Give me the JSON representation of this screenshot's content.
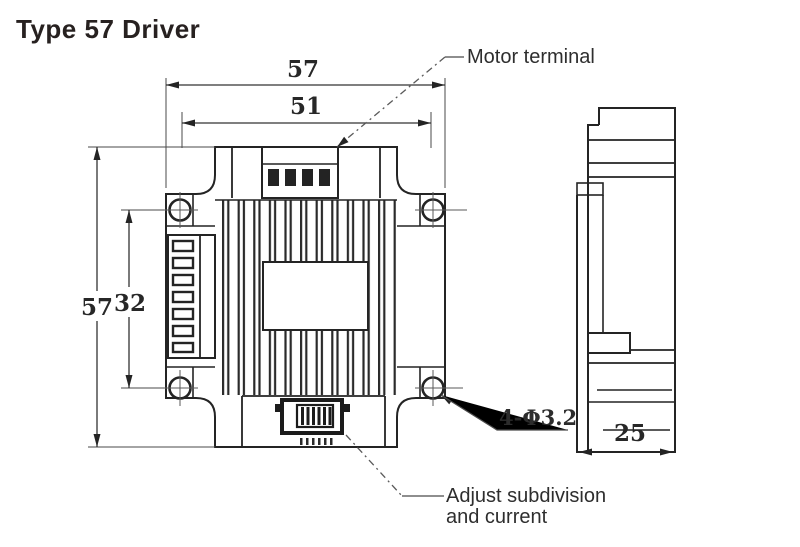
{
  "title": "Type 57 Driver",
  "dimensions": {
    "front_width_outer": "57",
    "front_width_holes": "51",
    "front_height_outer": "57",
    "front_height_holes": "32",
    "side_depth": "25",
    "mounting_holes": "4-Φ3.2"
  },
  "annotations": {
    "motor_terminal": "Motor terminal",
    "adjust_line1": "Adjust subdivision",
    "adjust_line2": "and current"
  },
  "colors": {
    "line": "#242424",
    "thin_line": "#4a4a4a",
    "text": "#2e2e2e",
    "background": "#ffffff"
  }
}
